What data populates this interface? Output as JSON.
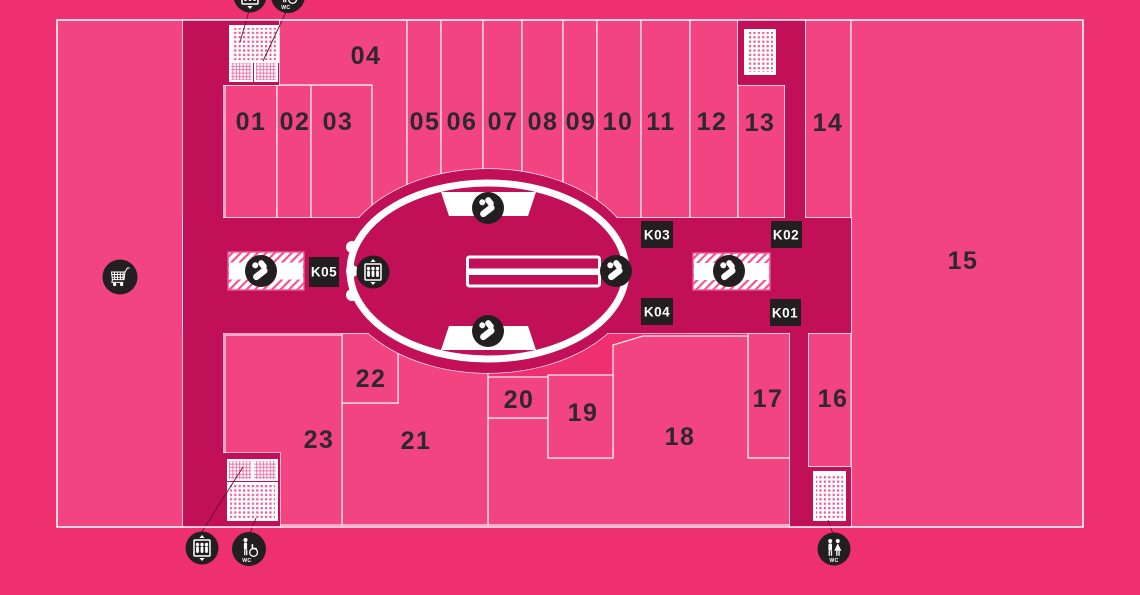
{
  "labels": {
    "wc": "WC"
  },
  "units": [
    "01",
    "02",
    "03",
    "04",
    "05",
    "06",
    "07",
    "08",
    "09",
    "10",
    "11",
    "12",
    "13",
    "14",
    "15",
    "16",
    "17",
    "18",
    "19",
    "20",
    "21",
    "22",
    "23"
  ],
  "kiosks": [
    "K05",
    "K03",
    "K02",
    "K04",
    "K01"
  ],
  "icons": {
    "cart": "shopping-cart",
    "elevator": "elevator",
    "escalator": "escalator",
    "stairs": "stairs",
    "wc": "toilets",
    "accessible_wc": "accessible-toilet"
  },
  "colors": {
    "background": "#EE2F70",
    "unit": "#F24480",
    "corridor": "#C10F58",
    "icon": "#231F20",
    "hatch": "#F15590",
    "text": "#2D292A"
  }
}
